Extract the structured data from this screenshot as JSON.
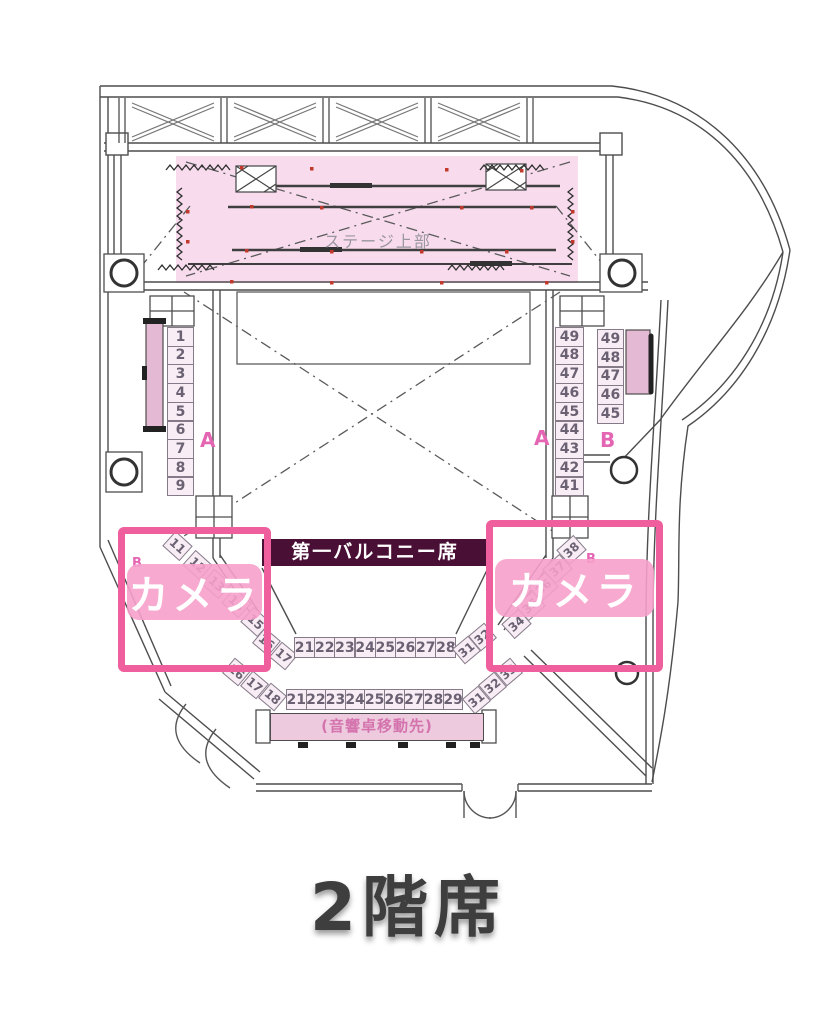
{
  "page_title": "2階席",
  "stage": {
    "label": "ステージ上部"
  },
  "balcony": {
    "banner": "第一バルコニー席"
  },
  "sound_console": {
    "label": "(音響卓移動先)"
  },
  "cameras": {
    "left_label": "カメラ",
    "right_label": "カメラ"
  },
  "section_labels": {
    "left_a": "A",
    "right_a": "A",
    "right_b_col": "B",
    "left_b_diag": "B",
    "right_b_diag": "B"
  },
  "seat_groups": {
    "left_column_a": [
      "1",
      "2",
      "3",
      "4",
      "5",
      "6",
      "7",
      "8",
      "9"
    ],
    "right_column_a": [
      "49",
      "48",
      "47",
      "46",
      "45",
      "44",
      "43",
      "42",
      "41"
    ],
    "right_column_b": [
      "49",
      "48",
      "47",
      "46",
      "45"
    ],
    "left_diagonal_b": [
      "11",
      "12",
      "13",
      "14",
      "15"
    ],
    "right_diagonal_b": [
      "38",
      "37",
      "36",
      "35",
      "34"
    ],
    "left_diag_row_a": [
      "16",
      "17"
    ],
    "left_diag_row_b": [
      "16",
      "17",
      "18"
    ],
    "center_row_a": [
      "21",
      "22",
      "23",
      "24",
      "25",
      "26",
      "27",
      "28"
    ],
    "center_row_b": [
      "21",
      "22",
      "23",
      "24",
      "25",
      "26",
      "27",
      "28",
      "29"
    ],
    "right_diag_row_a": [
      "31",
      "32"
    ],
    "right_diag_row_b": [
      "31",
      "32",
      "33"
    ]
  },
  "colors": {
    "camera_border": "#ef5f9e",
    "camera_band": "#f6a0c8",
    "banner_bg": "#4a0f35",
    "stage_fill": "#f8dcee",
    "seat_fill": "#f8edf5",
    "bench_fill": "#e4b9d4",
    "section_label": "#e466b3",
    "sound_text": "#d473ad",
    "title_text": "#3e3e3e",
    "wall_line": "#4d4d4d",
    "marker_red": "#c0392b"
  }
}
